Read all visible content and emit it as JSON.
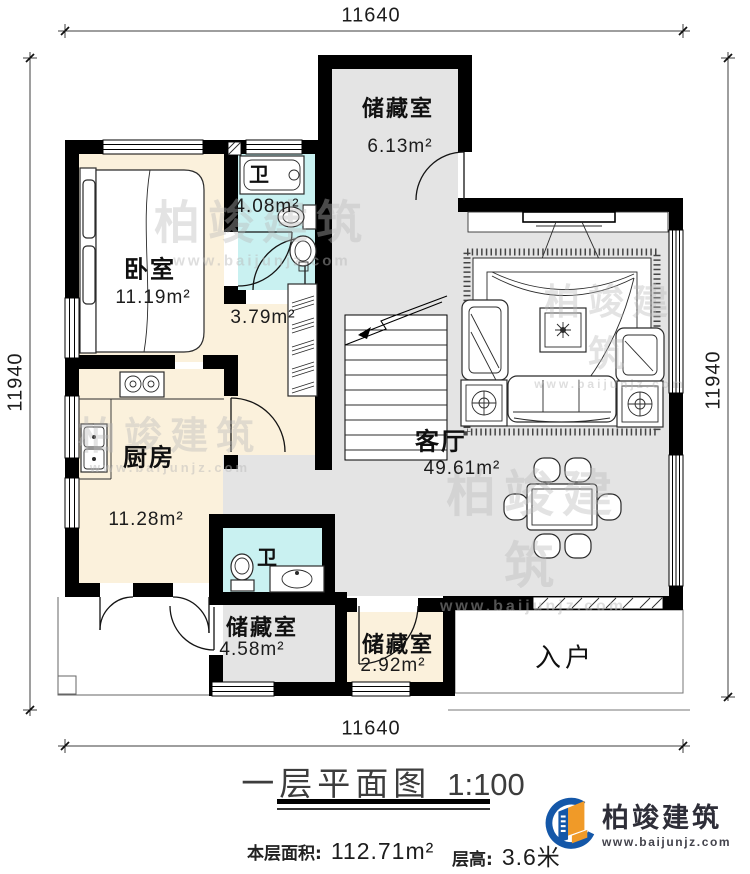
{
  "plan": {
    "title": "一层平面图",
    "scale": "1:100",
    "dimensions": {
      "top": "11640",
      "bottom": "11640",
      "left": "11940",
      "right": "11940"
    },
    "rooms": {
      "storage_top": {
        "name": "储藏室",
        "area": "6.13m²"
      },
      "bedroom": {
        "name": "卧室",
        "area": "11.19m²"
      },
      "bath_top": {
        "name": "卫",
        "area": "4.08m²"
      },
      "hall": {
        "area": "3.79m²"
      },
      "kitchen": {
        "name": "厨房",
        "area": "11.28m²"
      },
      "living": {
        "name": "客厅",
        "area": "49.61m²"
      },
      "bath_bottom": {
        "name": "卫"
      },
      "storage_left": {
        "name": "储藏室",
        "area": "4.58m²"
      },
      "storage_right": {
        "name": "储藏室",
        "area": "2.92m²"
      },
      "entry": {
        "name": "入户"
      }
    },
    "footer": {
      "area_label": "本层面积:",
      "area_value": "112.71m²",
      "height_label": "层高:",
      "height_value": "3.6米"
    },
    "logo": {
      "brand": "柏竣建筑",
      "url": "www.baijunjz.com"
    },
    "watermark": {
      "brand": "柏竣建筑",
      "url": "www.baijunjz.com"
    },
    "colors": {
      "wall": "#000000",
      "room_warm": "#fbf1dc",
      "room_cool": "#c9f1f1",
      "room_gray": "#e4e4e4",
      "logo_blue": "#1457a8",
      "logo_orange": "#f09a28"
    }
  }
}
